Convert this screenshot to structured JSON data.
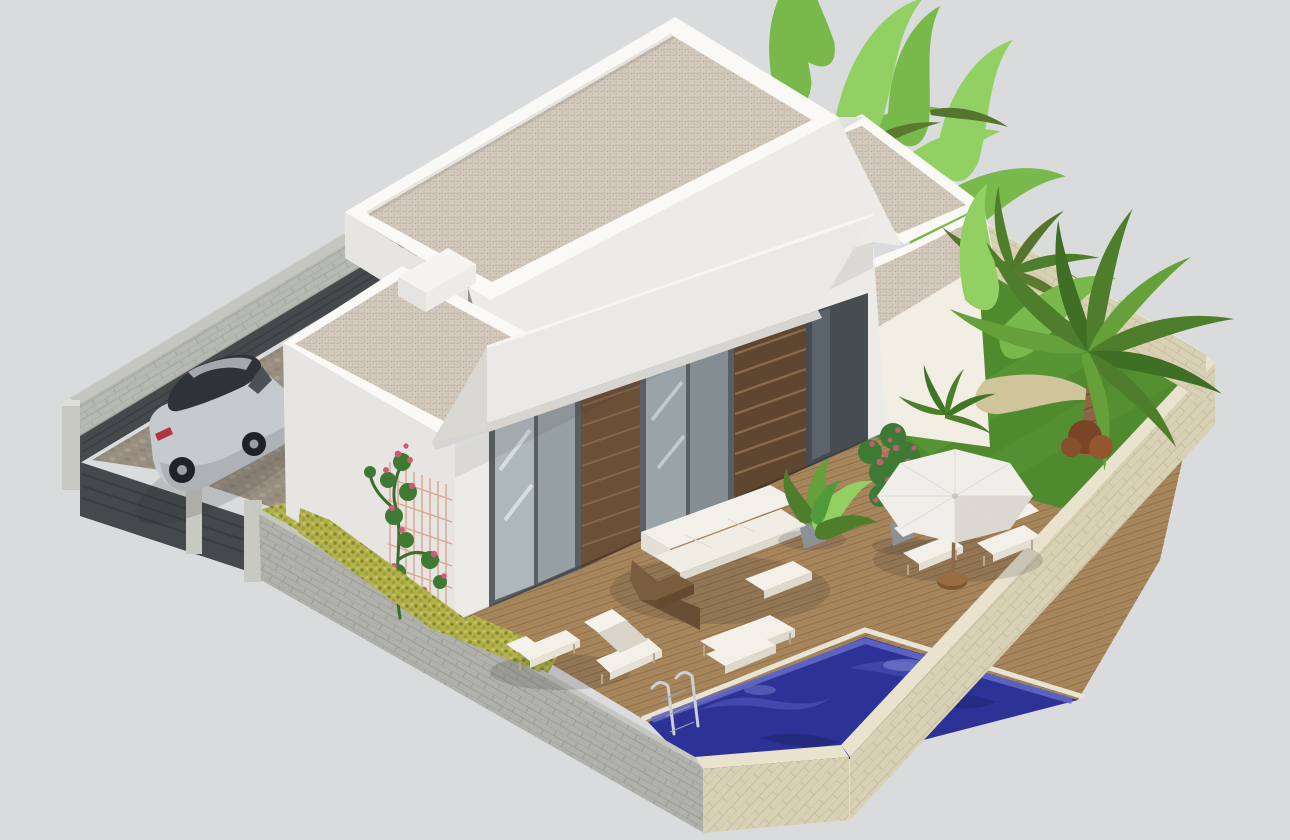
{
  "scene": {
    "title": "Modern villa 3D architectural visualization",
    "style": "isometric aerial render",
    "setting": "single-storey white villa with flat gravel roofs, covered terrace, wooden deck, private pool and tropical garden inside a walled plot; silver SUV parked on a cobbled driveway",
    "canvas": {
      "width": 1290,
      "height": 840
    }
  },
  "colors": {
    "background": "#d9dbdc",
    "wall_white_lit": "#f2eee4",
    "wall_white_shade": "#e7e5e2",
    "parapet_top": "#faf9f6",
    "facade_white": "#edebe7",
    "roof_gravel": "#d2c9bc",
    "awning": "#eae9e5",
    "awning_fascia": "#d6d5d0",
    "glass_light": "#aeb7bc",
    "glass_dark": "#454c52",
    "frame_dark": "#5a5f64",
    "wood_slats": "#6b4f36",
    "deck_wood": "#a8865c",
    "pool_water": "#2c3296",
    "pool_deep": "#1f246e",
    "pool_wave": "#545cc0",
    "lawn": "#4f8a2f",
    "lawn_light": "#61a03c",
    "hedge": "#b2b14c",
    "hedge_dark": "#83882c",
    "stone_wall_beige": "#d9d1b5",
    "stone_wall_beige_top": "#e9e3cd",
    "stone_wall_gray": "#b0b1aa",
    "stone_wall_gray_top": "#c5c6c0",
    "block_wall": "#b6b8b2",
    "dark_fence": "#45494c",
    "post_concrete": "#c8c9c1",
    "cobbles": "#998f80",
    "cobble_stone": "#a89f90",
    "car_body": "#c6c9cd",
    "car_glass": "#2e3339",
    "wheel": "#1f2226",
    "taillight": "#b23440",
    "palm_green": "#4e7e2b",
    "palm_light": "#66a03a",
    "banana_green": "#79b94b",
    "banana_light": "#93d063",
    "trunk_brown": "#8a6845",
    "rose_green": "#3e7a33",
    "rose_pink": "#c95f74",
    "parasol": "#f0eee9",
    "parasol_shade": "#dbd8d1",
    "pot_gray": "#8d9094",
    "furniture_white": "#f3f0e9",
    "wicker_brown": "#7a5c3e"
  },
  "objects": [
    {
      "name": "villa-house",
      "label": "Modern white villa with stepped flat roofs"
    },
    {
      "name": "roof-gravel",
      "label": "Gravel-covered flat roofs with white parapets"
    },
    {
      "name": "awning",
      "label": "White terrace awning"
    },
    {
      "name": "glass-sliding-doors",
      "label": "Floor-to-ceiling sliding glass doors"
    },
    {
      "name": "wood-slat-panels",
      "label": "Dark wood slat facade panels"
    },
    {
      "name": "terrace-deck",
      "label": "Wooden terrace deck"
    },
    {
      "name": "outdoor-sofa-set",
      "label": "White outdoor sofa, coffee table and ottomans"
    },
    {
      "name": "sun-loungers",
      "label": "Two white sun loungers near pool"
    },
    {
      "name": "parasol",
      "label": "White parasol with two deck chairs"
    },
    {
      "name": "swimming-pool",
      "label": "Blue mosaic swimming pool with chrome ladder"
    },
    {
      "name": "lawn",
      "label": "Green lawn"
    },
    {
      "name": "palm-tree",
      "label": "Palm tree"
    },
    {
      "name": "banana-plants",
      "label": "Banana plants behind the house"
    },
    {
      "name": "shrub",
      "label": "Brown shrub"
    },
    {
      "name": "hedge",
      "label": "Yellow-green hedge along side wall"
    },
    {
      "name": "rose-trellis",
      "label": "Climbing rose on trellis"
    },
    {
      "name": "potted-plants",
      "label": "Potted green and flowering plants"
    },
    {
      "name": "car",
      "label": "Silver SUV parked in driveway"
    },
    {
      "name": "driveway",
      "label": "Cobbled driveway"
    },
    {
      "name": "privacy-fence",
      "label": "Dark slat privacy fence and entrance gate"
    },
    {
      "name": "perimeter-walls",
      "label": "Stone perimeter walls around the plot"
    }
  ]
}
